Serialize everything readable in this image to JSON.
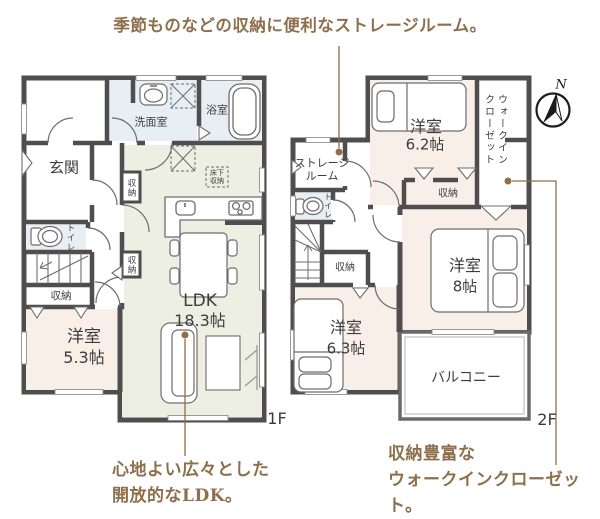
{
  "annotations": {
    "title": "季節ものなどの収納に便利なストレージルーム。",
    "caption_ldk": [
      "心地よい広々とした",
      "開放的なLDK。"
    ],
    "caption_wic": [
      "収納豊富な",
      "ウォークインクローゼット。"
    ]
  },
  "floor1f": {
    "floor_label": "1F",
    "rooms": {
      "entrance": "玄関",
      "washroom": "洗面室",
      "bathroom": "浴室",
      "toilet": "トイレ",
      "ldk_name": "LDK",
      "ldk_size": "18.3帖",
      "bedroom_name": "洋室",
      "bedroom_size": "5.3帖",
      "closet_upper": "収納",
      "closet_lower": "収納",
      "closet_stairs": "収納",
      "underfloor_storage": [
        "床下",
        "収納"
      ]
    }
  },
  "floor2f": {
    "floor_label": "2F",
    "compass": "N",
    "rooms": {
      "storage_room": [
        "ストレージ",
        "ルーム"
      ],
      "bedroom62_name": "洋室",
      "bedroom62_size": "6.2帖",
      "wic_vertical": [
        "ウォークイン",
        "クローゼット"
      ],
      "closet_62": "収納",
      "toilet": "トイレ",
      "closet_hall": "収納",
      "bedroom8_name": "洋室",
      "bedroom8_size": "8帖",
      "bedroom63_name": "洋室",
      "bedroom63_size": "6.3帖",
      "balcony": "バルコニー"
    }
  },
  "colors": {
    "wall": "#504d4e",
    "water_room_fill": "#e7eff4",
    "ldk_fill": "#edefe2",
    "bedroom_fill": "#f8efe9",
    "accent_brown": "#8e6f4b",
    "label_text": "#3f3c3d"
  }
}
